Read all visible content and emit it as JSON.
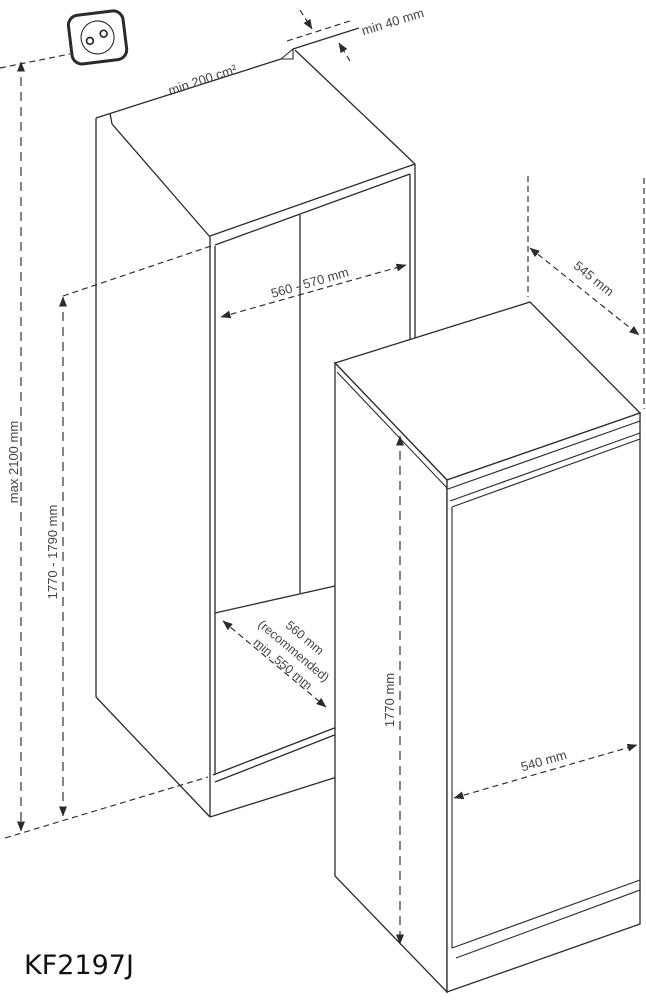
{
  "model_label": "KF2197J",
  "icons": {
    "power_outlet": "power-outlet"
  },
  "colors": {
    "line": "#2b2b2b",
    "text": "#444444",
    "background": "#ffffff"
  },
  "dimensions": {
    "vent_area": "min 200 cm²",
    "rear_top_clearance": "min 40 mm",
    "niche_width": "560 - 570 mm",
    "overall_height_max": "max 2100 mm",
    "niche_height": "1770 - 1790 mm",
    "niche_depth_value": "560 mm",
    "niche_depth_note": "(recommended)",
    "niche_depth_min": "min. 550 mm",
    "appliance_depth": "545 mm",
    "appliance_height": "1770 mm",
    "appliance_width": "540 mm"
  }
}
